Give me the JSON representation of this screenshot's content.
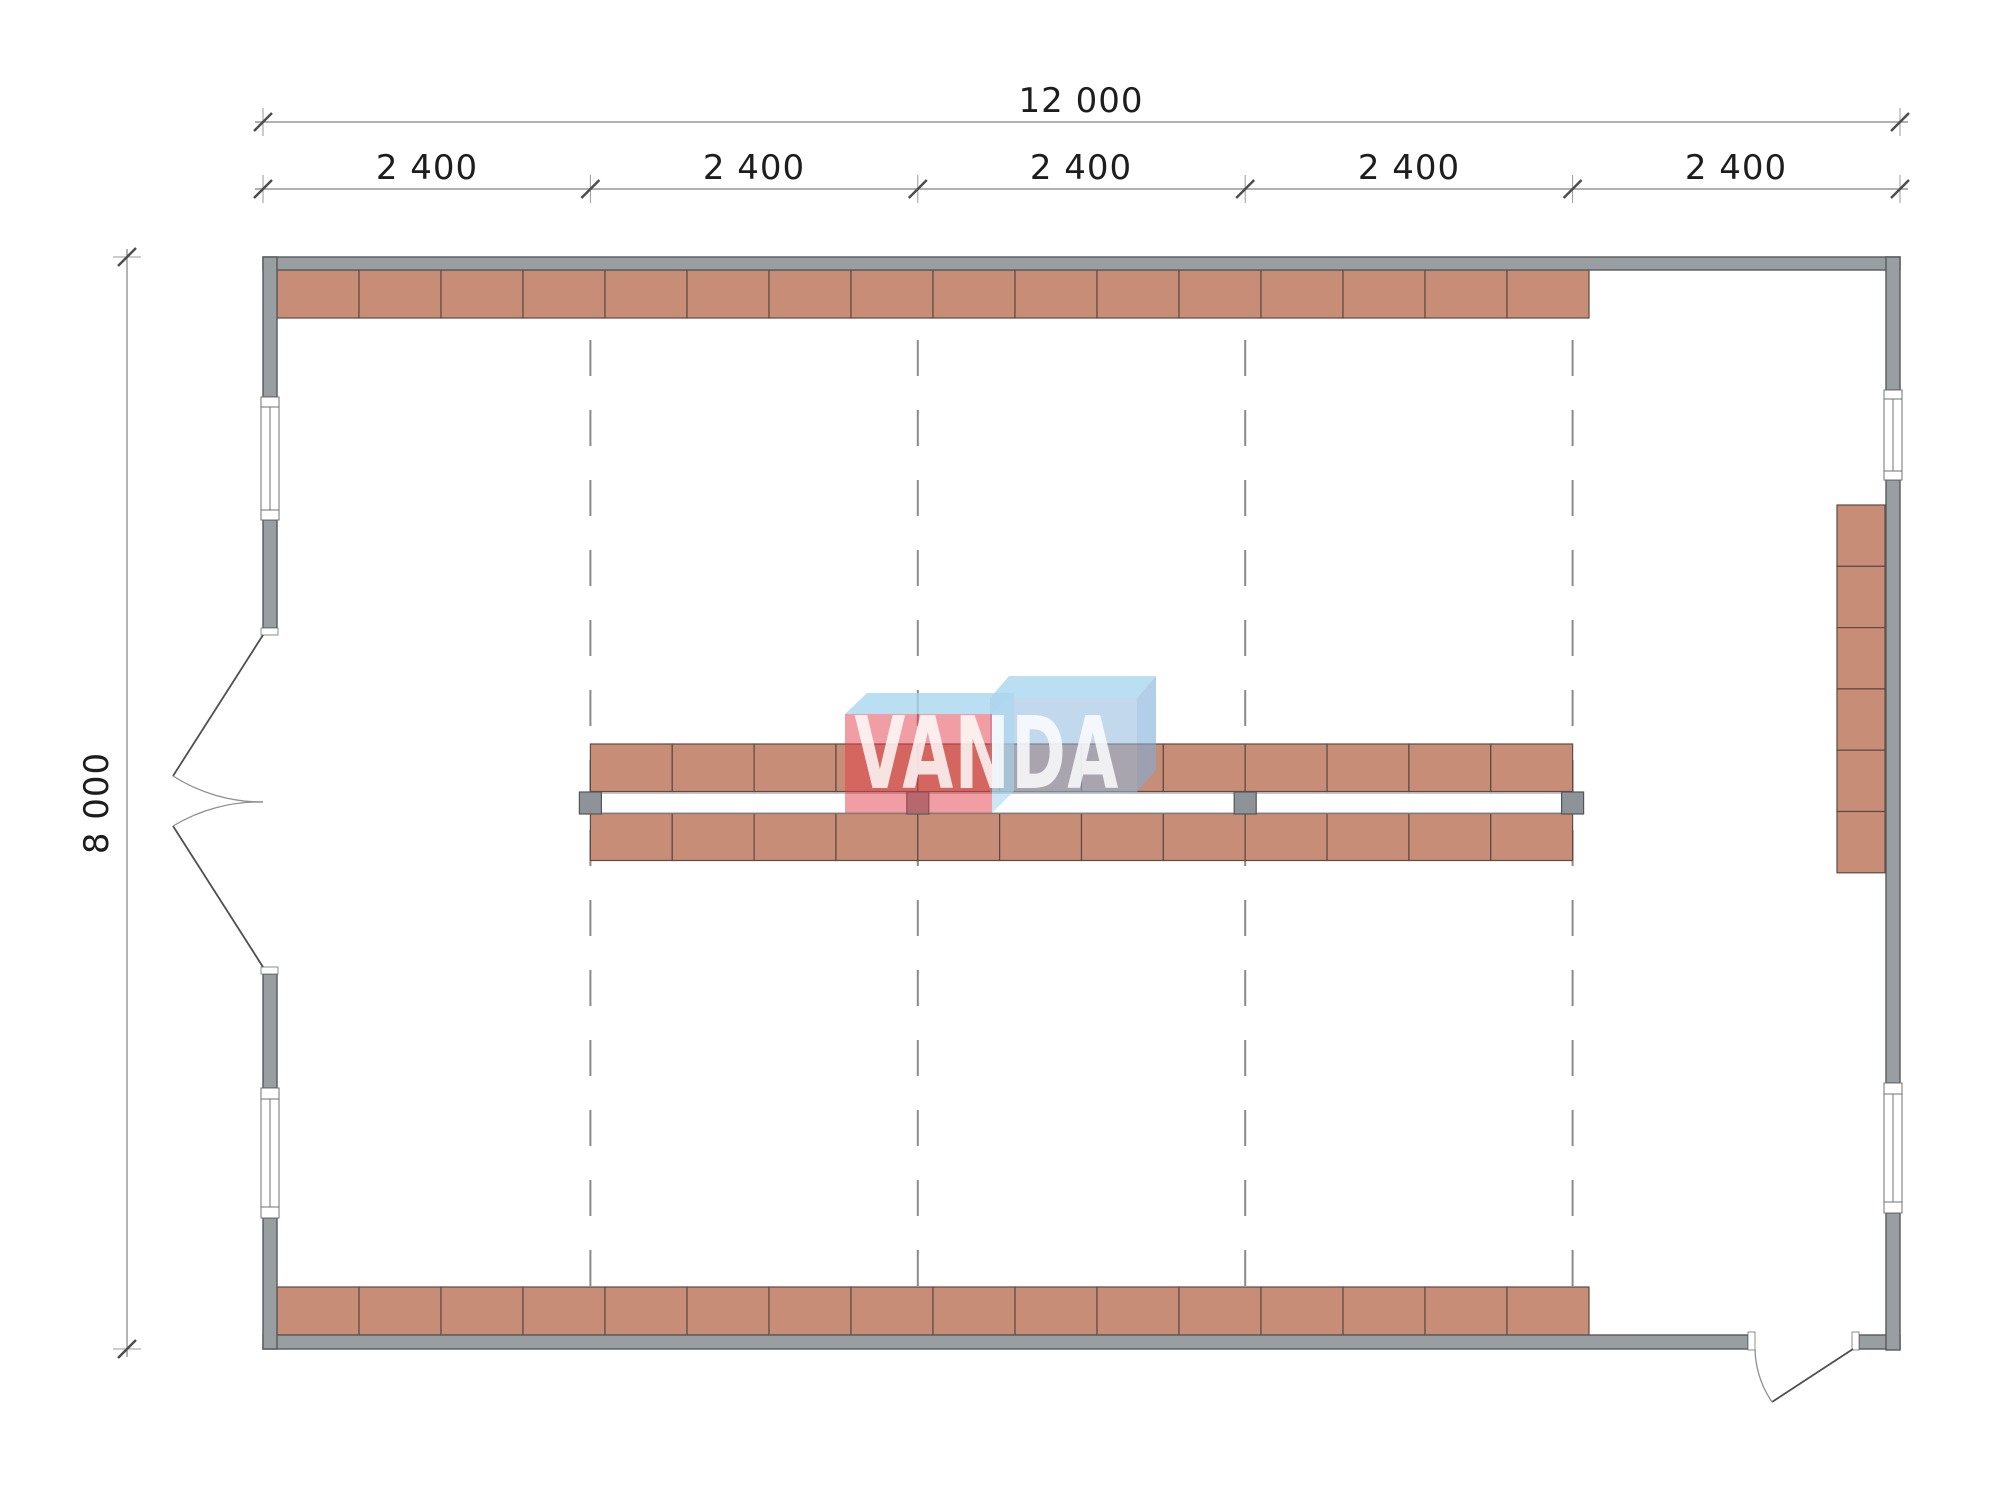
{
  "drawing": {
    "type": "floor-plan",
    "watermark": {
      "text": "VANDA"
    },
    "dimensions": {
      "total_width": "12 000",
      "segments": [
        "2 400",
        "2 400",
        "2 400",
        "2 400",
        "2 400"
      ],
      "height": "8 000"
    },
    "shelving": {
      "top_row_units": 16,
      "bottom_row_units": 16,
      "center_upper_units": 12,
      "center_lower_units": 12,
      "right_column_units": 6,
      "post_count": 4
    },
    "colors": {
      "wall_fill": "#999ea1",
      "wall_stroke": "#55595c",
      "shelf_fill": "#c78d76",
      "shelf_stroke": "#5e4a40",
      "post_fill": "#8d9396",
      "post_stroke": "#50555a",
      "grid_line": "#8a8a8a",
      "dim_line": "#828282",
      "tick": "#4c4c4c",
      "dim_text": "#1d1d1d",
      "window_stroke": "#6d7174",
      "door_leaf": "#4f4f4f",
      "door_arc": "#8f8f8f",
      "aisle_stroke": "#9aa0a3",
      "logo_red": "rgba(226,62,72,0.5)",
      "logo_blue_front": "rgba(143,186,223,0.55)",
      "logo_blue_side": "rgba(126,173,216,0.6)",
      "logo_light_blue": "rgba(168,214,238,0.78)"
    }
  }
}
